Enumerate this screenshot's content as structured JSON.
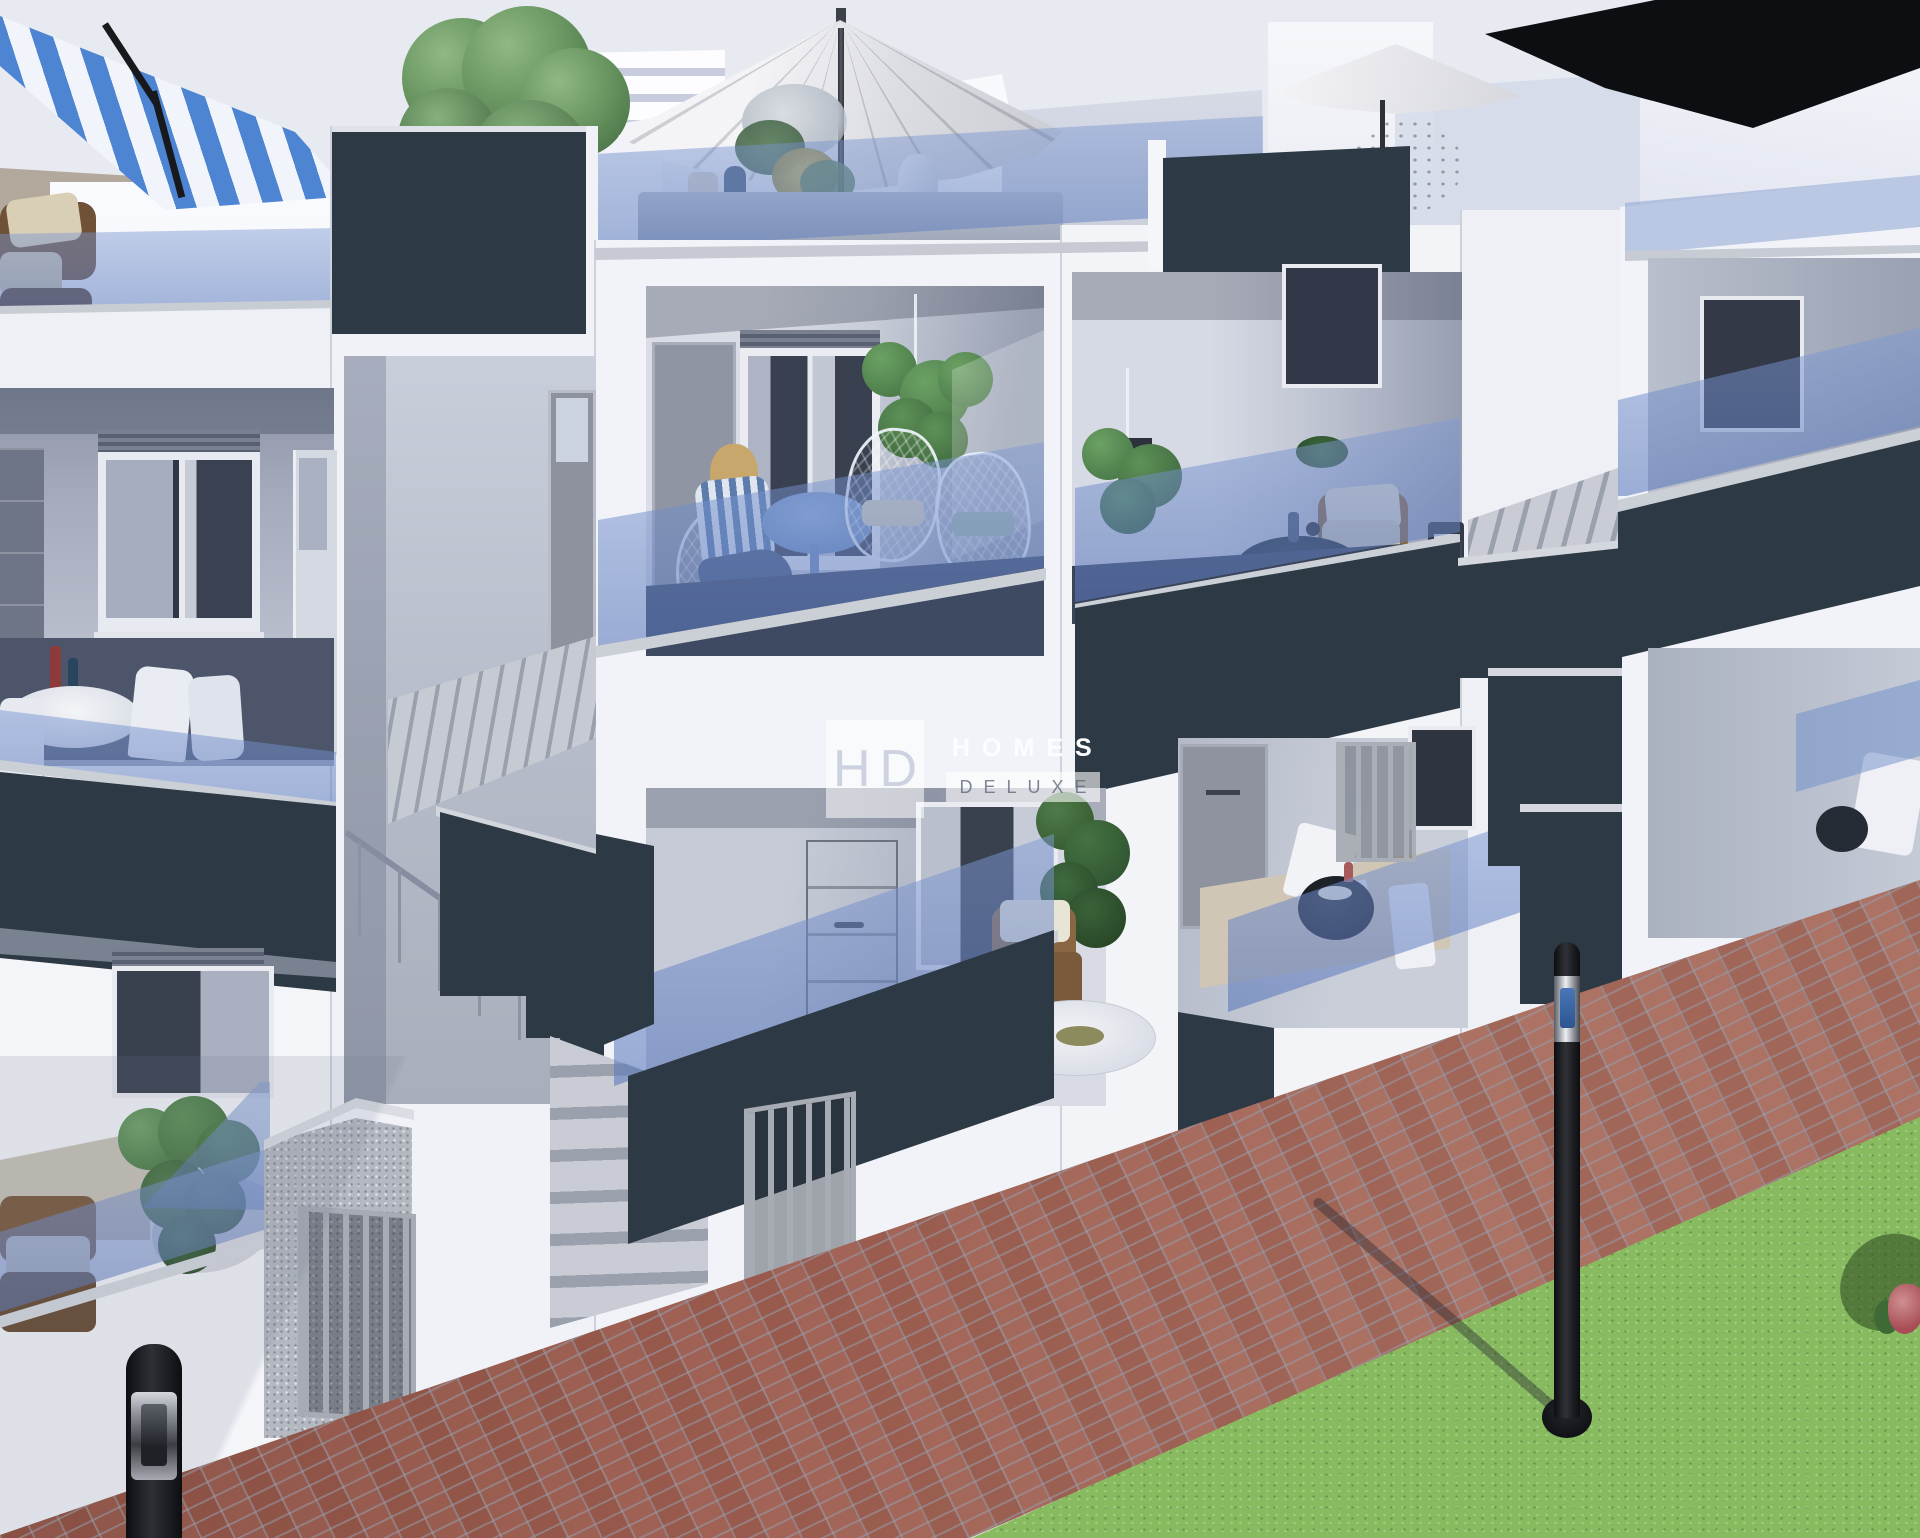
{
  "watermark": {
    "initials": "HD",
    "line1": "HOMES",
    "line2": "DELUXE"
  },
  "palette": {
    "sky": "#e8eaf1",
    "wall": "#f1f3f8",
    "wall_shade": "#c6cbd8",
    "balcony_shade": "#98a0b2",
    "fascia": "#2d3944",
    "cap": "#cbcfd6",
    "granite": "#b4b8c1",
    "metal": "#a6abb4",
    "brick": "#a06254",
    "grass": "#88ba60",
    "foliage": "#5d8a58",
    "foliage_dark": "#3f6b40",
    "wicker": "#8a6742",
    "lamp": "#0d0e11",
    "cushion": "#d9cfb6",
    "umbrella_blue": "#4d85d2"
  }
}
